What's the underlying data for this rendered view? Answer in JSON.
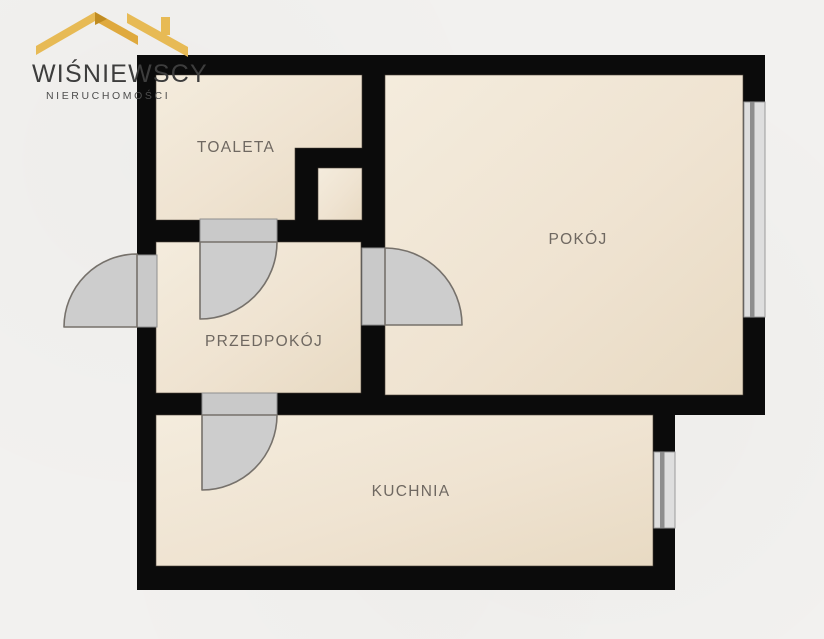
{
  "brand": {
    "name": "WIŚNIEWSCY",
    "tagline": "NIERUCHOMOŚCI",
    "logo_icon": "gold-roof-house-icon"
  },
  "floorplan": {
    "rooms": {
      "toaleta": {
        "label": "TOALETA"
      },
      "pokoj": {
        "label": "POKÓJ"
      },
      "przedpokoj": {
        "label": "PRZEDPOKÓJ"
      },
      "kuchnia": {
        "label": "KUCHNIA"
      }
    },
    "features": {
      "doors": [
        "entry-door",
        "toaleta-door",
        "pokoj-door",
        "kuchnia-door"
      ],
      "windows": [
        "pokoj-window",
        "kuchnia-window"
      ],
      "shafts": [
        "vent-shaft"
      ]
    },
    "colors": {
      "background": "#f2f1ef",
      "wall": "#0b0b0b",
      "floor": "#efe3d1",
      "door_leaf": "#cdcdcd",
      "door_threshold": "#c9c9c9",
      "window": "#dedede",
      "window_mullion": "#8d8d8d",
      "label_text": "#6f6861",
      "brand_gold": "#e7ba55",
      "brand_gold_dark": "#dfa93e",
      "brand_gold_fold": "#c08c22",
      "brand_text": "#3d3d3d"
    }
  }
}
